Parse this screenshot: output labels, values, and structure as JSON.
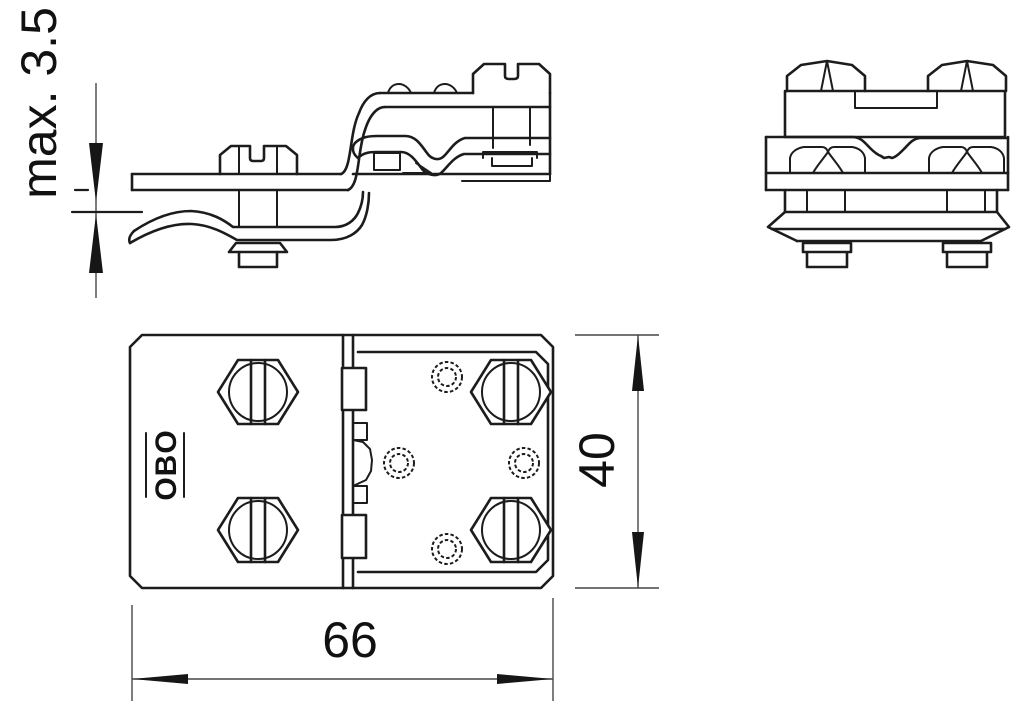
{
  "palette": {
    "background": "#ffffff",
    "line": "#1c1c1c",
    "dimension_line": "#474747"
  },
  "labels": {
    "max_thickness": "max. 3.5",
    "plate_width": "66",
    "plate_height": "40",
    "brand_mark": "OBO"
  }
}
